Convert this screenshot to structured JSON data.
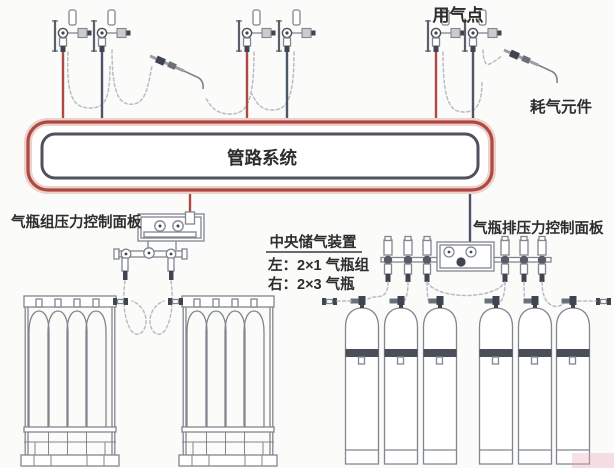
{
  "labels": {
    "gas_use_point": "用气点",
    "gas_consuming_element": "耗气元件",
    "piping_system": "管路系统",
    "left_panel": "气瓶组压力控制面板",
    "right_panel": "气瓶排压力控制面板"
  },
  "central_storage_note": {
    "title": "中央储气装置",
    "left_line": "左：2×1 气瓶组",
    "right_line": "右：2×3 气瓶"
  },
  "colors": {
    "background": "#fbfbfa",
    "text": "#2d2d2d",
    "pipe_red": "#ae4843",
    "pipe_red_halo": "#ecd0ca",
    "pipe_dark": "#4e535e",
    "line_dark": "#4d5568",
    "equipment": "#81868f",
    "equipment_dark": "#3f4450",
    "hose": "#b9bcc1"
  },
  "structure": {
    "outlet_points": 6,
    "torches": 2,
    "cylinder_bundles": 2,
    "single_cylinders": 6
  }
}
